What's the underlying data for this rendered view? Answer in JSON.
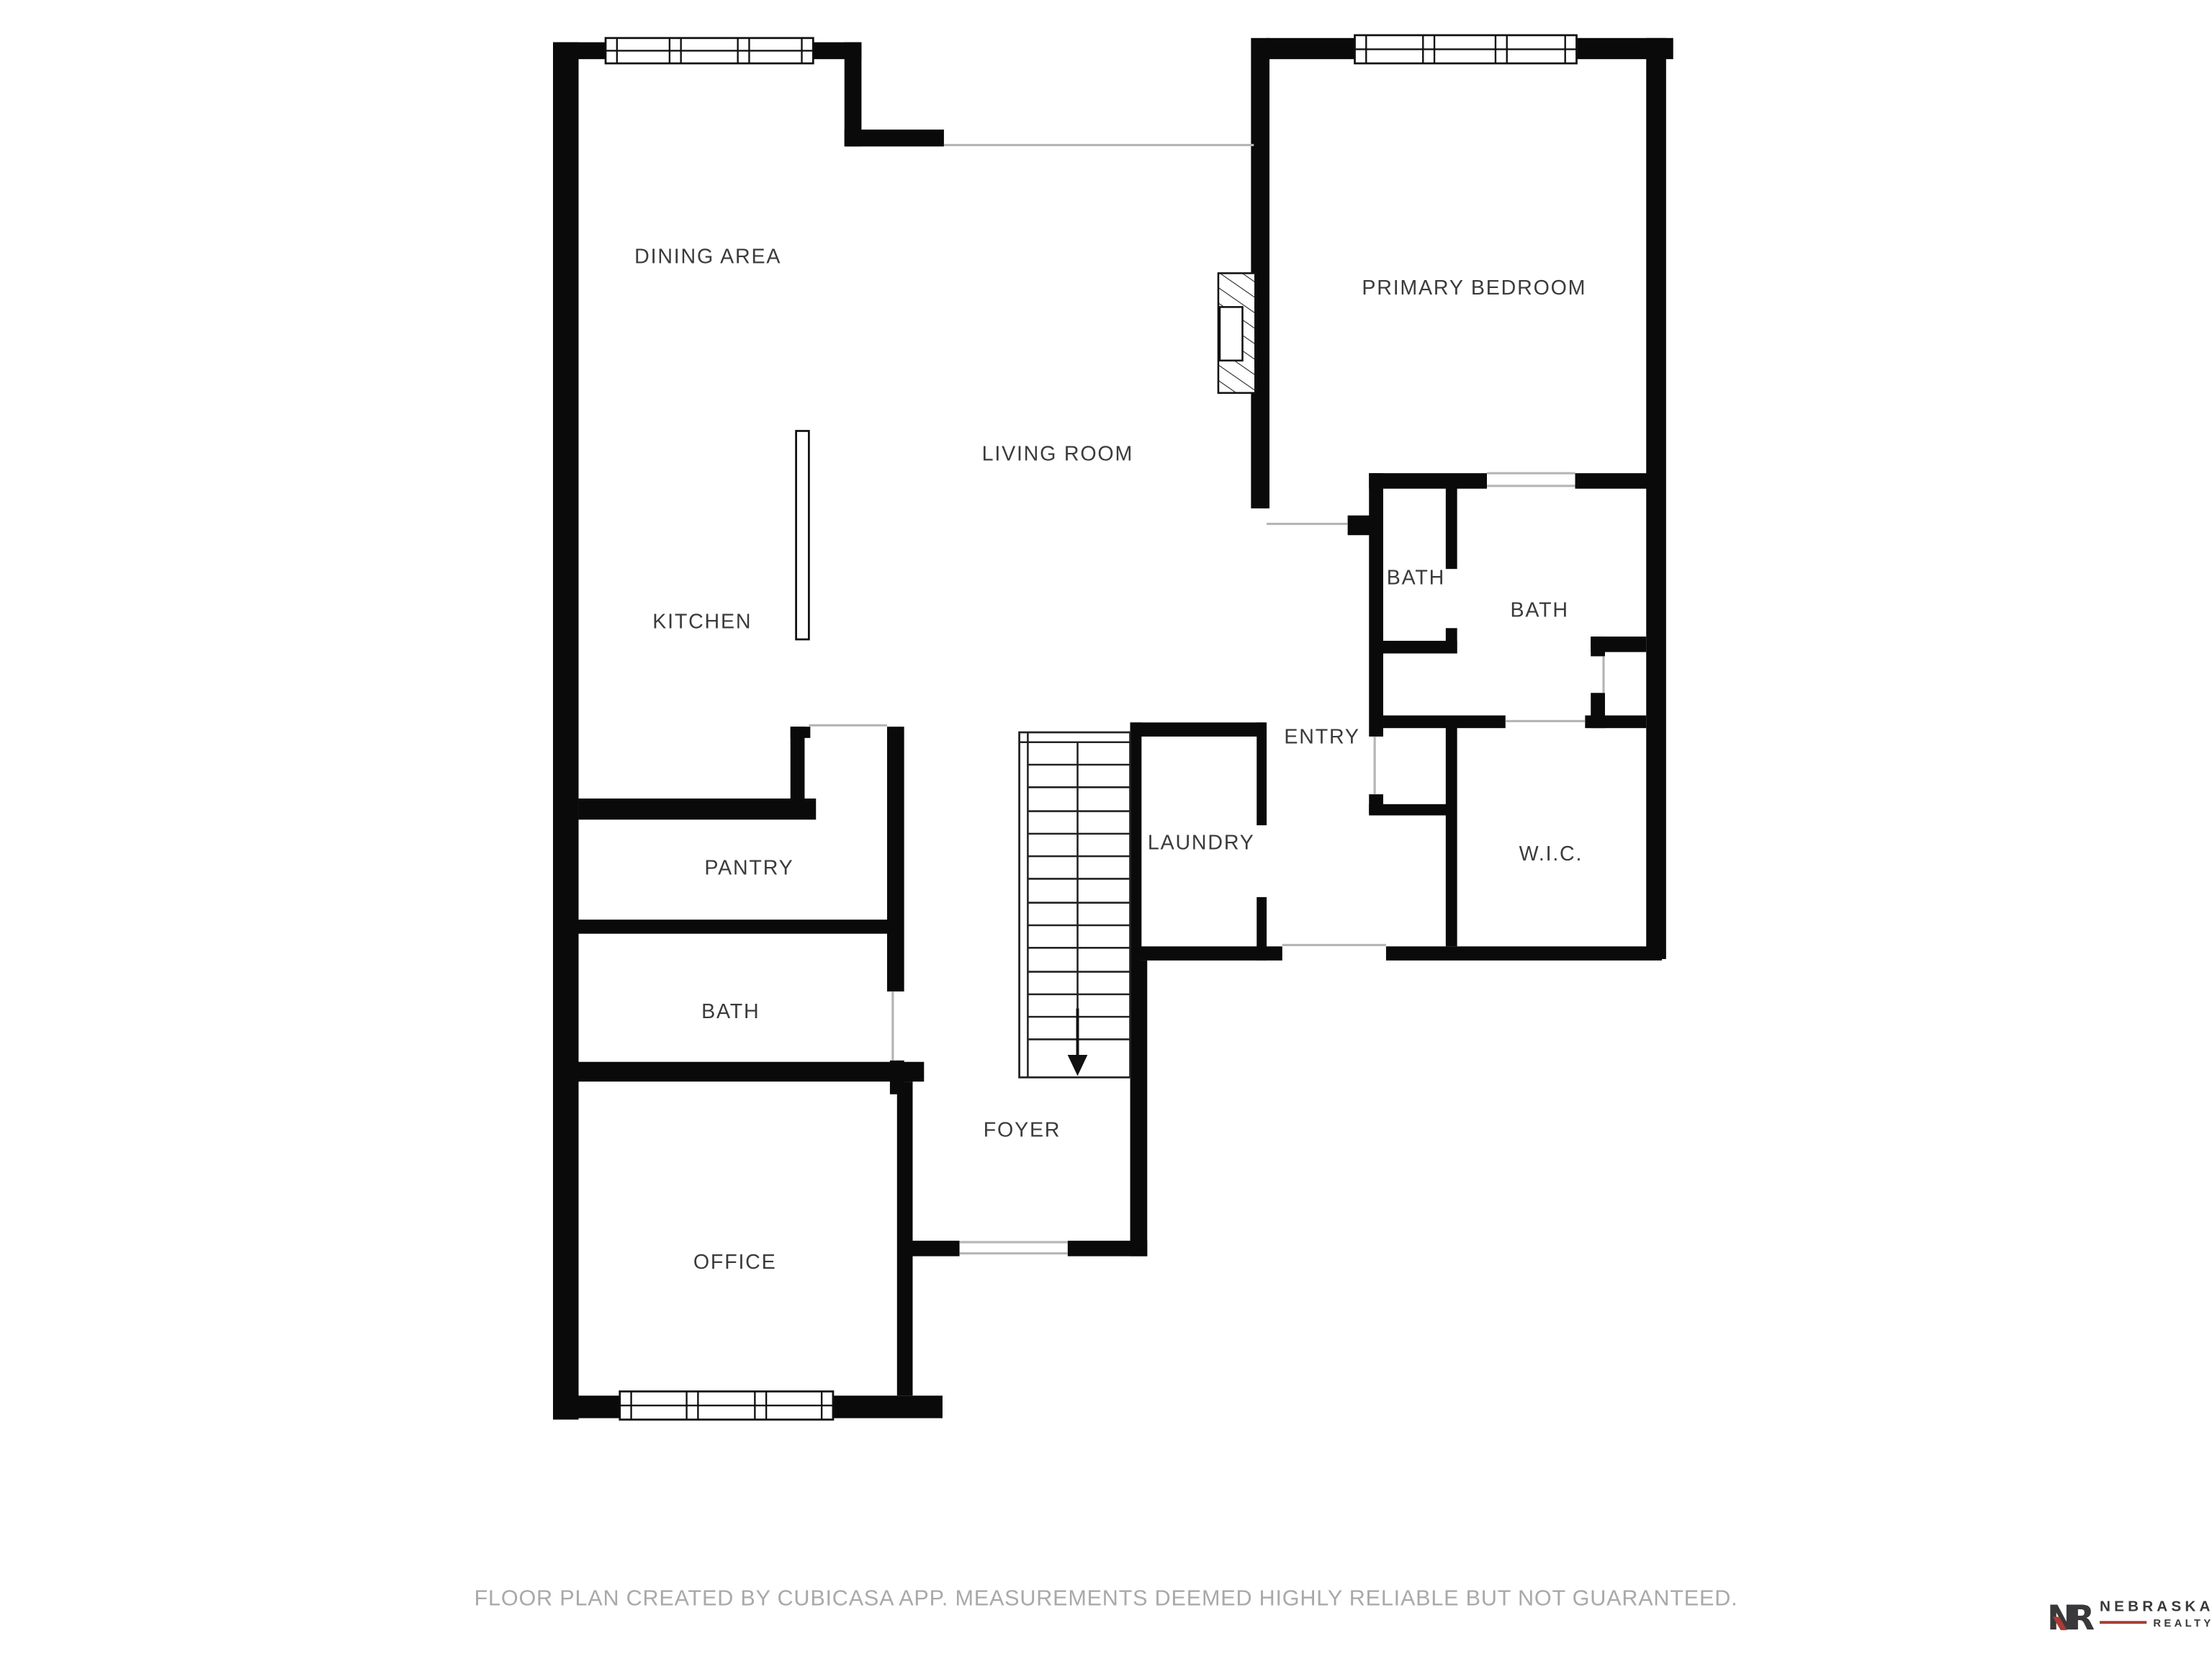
{
  "rooms": {
    "dining_area": {
      "label": "DINING AREA"
    },
    "primary_bedroom": {
      "label": "PRIMARY BEDROOM"
    },
    "living_room": {
      "label": "LIVING ROOM"
    },
    "kitchen": {
      "label": "KITCHEN"
    },
    "bath_upper": {
      "label": "BATH"
    },
    "bath_primary": {
      "label": "BATH"
    },
    "entry": {
      "label": "ENTRY"
    },
    "laundry": {
      "label": "LAUNDRY"
    },
    "wic": {
      "label": "W.I.C."
    },
    "pantry": {
      "label": "PANTRY"
    },
    "bath_lower": {
      "label": "BATH"
    },
    "foyer": {
      "label": "FOYER"
    },
    "office": {
      "label": "OFFICE"
    }
  },
  "footer": {
    "disclaimer": "FLOOR PLAN CREATED BY CUBICASA APP. MEASUREMENTS DEEMED HIGHLY RELIABLE BUT NOT GUARANTEED."
  },
  "logo": {
    "monogram": "NR",
    "brand": "NEBRASKA",
    "suffix": "REALTY"
  },
  "colors": {
    "wall": "#0a0a0a",
    "label": "#3b3b3b",
    "opening_line": "#b5b5b5",
    "footer_text": "#a9a9a9",
    "logo_dark": "#3a383b",
    "logo_red": "#aa3b33"
  }
}
